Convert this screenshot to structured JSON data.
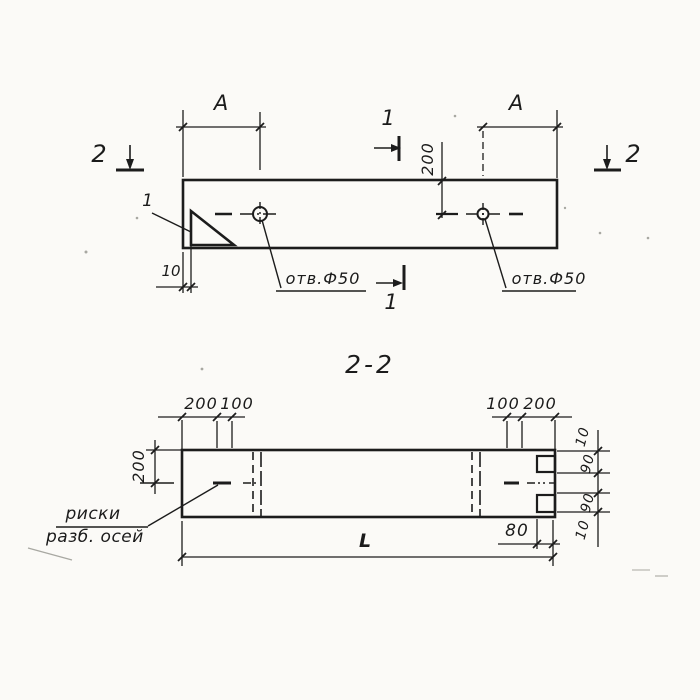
{
  "colors": {
    "ink": "#1c1c1c",
    "thin_ink": "#2b2b2b",
    "paper": "#fbfaf7",
    "speckle": "#9a9a94"
  },
  "plan_view": {
    "section_mark_2_left": "2",
    "section_mark_2_right": "2",
    "section_mark_1_top": "1",
    "section_mark_1_bottom": "1",
    "dim_a_left": "А",
    "dim_a_right": "А",
    "dim_hole_offset": "200",
    "dim_edge_offset": "10",
    "hole_label_left": "отв.Ф50",
    "hole_label_right": "отв.Ф50",
    "detail_callout": "1"
  },
  "section_view": {
    "title": "2-2",
    "top_dims_left": [
      "200",
      "100"
    ],
    "top_dims_right": [
      "100",
      "200"
    ],
    "dim_height": "200",
    "right_dims": [
      "10",
      "90",
      "90",
      "10"
    ],
    "dim_notch": "80",
    "dim_length": "L",
    "axes_note_line1": "риски",
    "axes_note_line2": "разб. осей"
  }
}
